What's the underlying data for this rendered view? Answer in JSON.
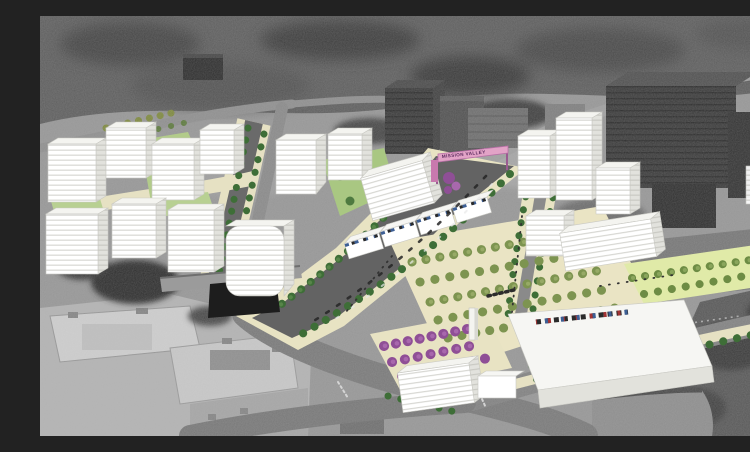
{
  "meta": {
    "width": 750,
    "height": 420
  },
  "scene": {
    "kind": "aerial-photomontage-rendering",
    "description": "Oblique aerial photograph (grayscale) over-painted with a proposed urban district: white massing buildings, tree-lined boulevard, plaza with tree grid, purple flowering trees and a pink gateway banner spanning the main road.",
    "gateway_banner": {
      "text": "MISSION VALLEY"
    }
  },
  "palette": {
    "aerial_dark": "#4a4a4a",
    "aerial_mid": "#8d8d8d",
    "aerial_light": "#c6c6c6",
    "massing_white": "#f7f7f4",
    "massing_side": "#dededa",
    "floor_line": "#d4d4cf",
    "asphalt_new": "#636363",
    "paving_cream": "#e8e3c3",
    "lawn_green": "#b2cb8a",
    "parkway_green": "#e0eaa8",
    "street_tree": "#3e6e37",
    "plaza_tree": "#7d9450",
    "flowering_purple": "#8f4f96",
    "banner_pink": "#e2a3c7",
    "banner_post": "#9a5b91",
    "storefront_blue": "#3d5f94",
    "storefront_dark": "#2a2a2a",
    "storefront_red": "#a23434"
  }
}
